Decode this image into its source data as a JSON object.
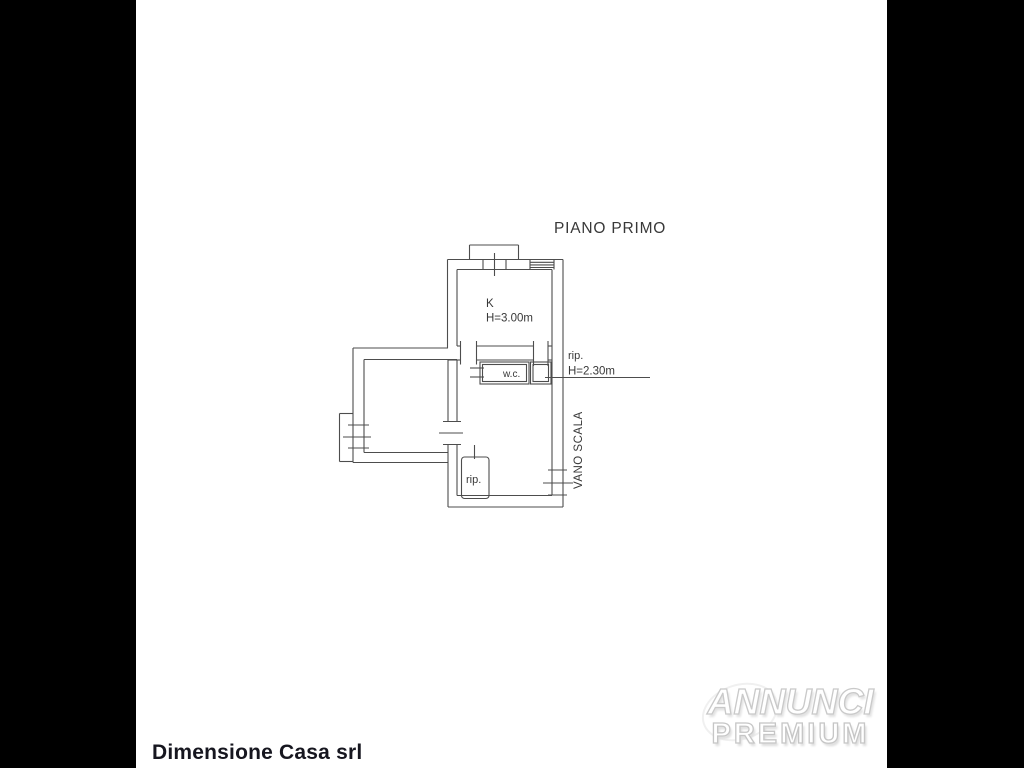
{
  "plan": {
    "title": "PIANO PRIMO",
    "kitchen_label": "K",
    "kitchen_height": "H=3.00m",
    "wc_label": "w.c.",
    "closet_label": "rip.",
    "closet_height": "H=2.30m",
    "storage_label": "rip.",
    "stairwell_label": "VANO SCALA"
  },
  "footer": {
    "company_name": "Dimensione Casa srl"
  },
  "watermark": {
    "brand_top": "ANNUNCI",
    "brand_bottom": "PREMIUM"
  },
  "colors": {
    "background": "#ffffff",
    "side_bars": "#000000",
    "plan_lines": "#4d4d4d",
    "plan_text": "#383838",
    "company_text": "#16161f",
    "watermark_fill": "#ffffff",
    "watermark_outline": "#c9c9c9"
  }
}
